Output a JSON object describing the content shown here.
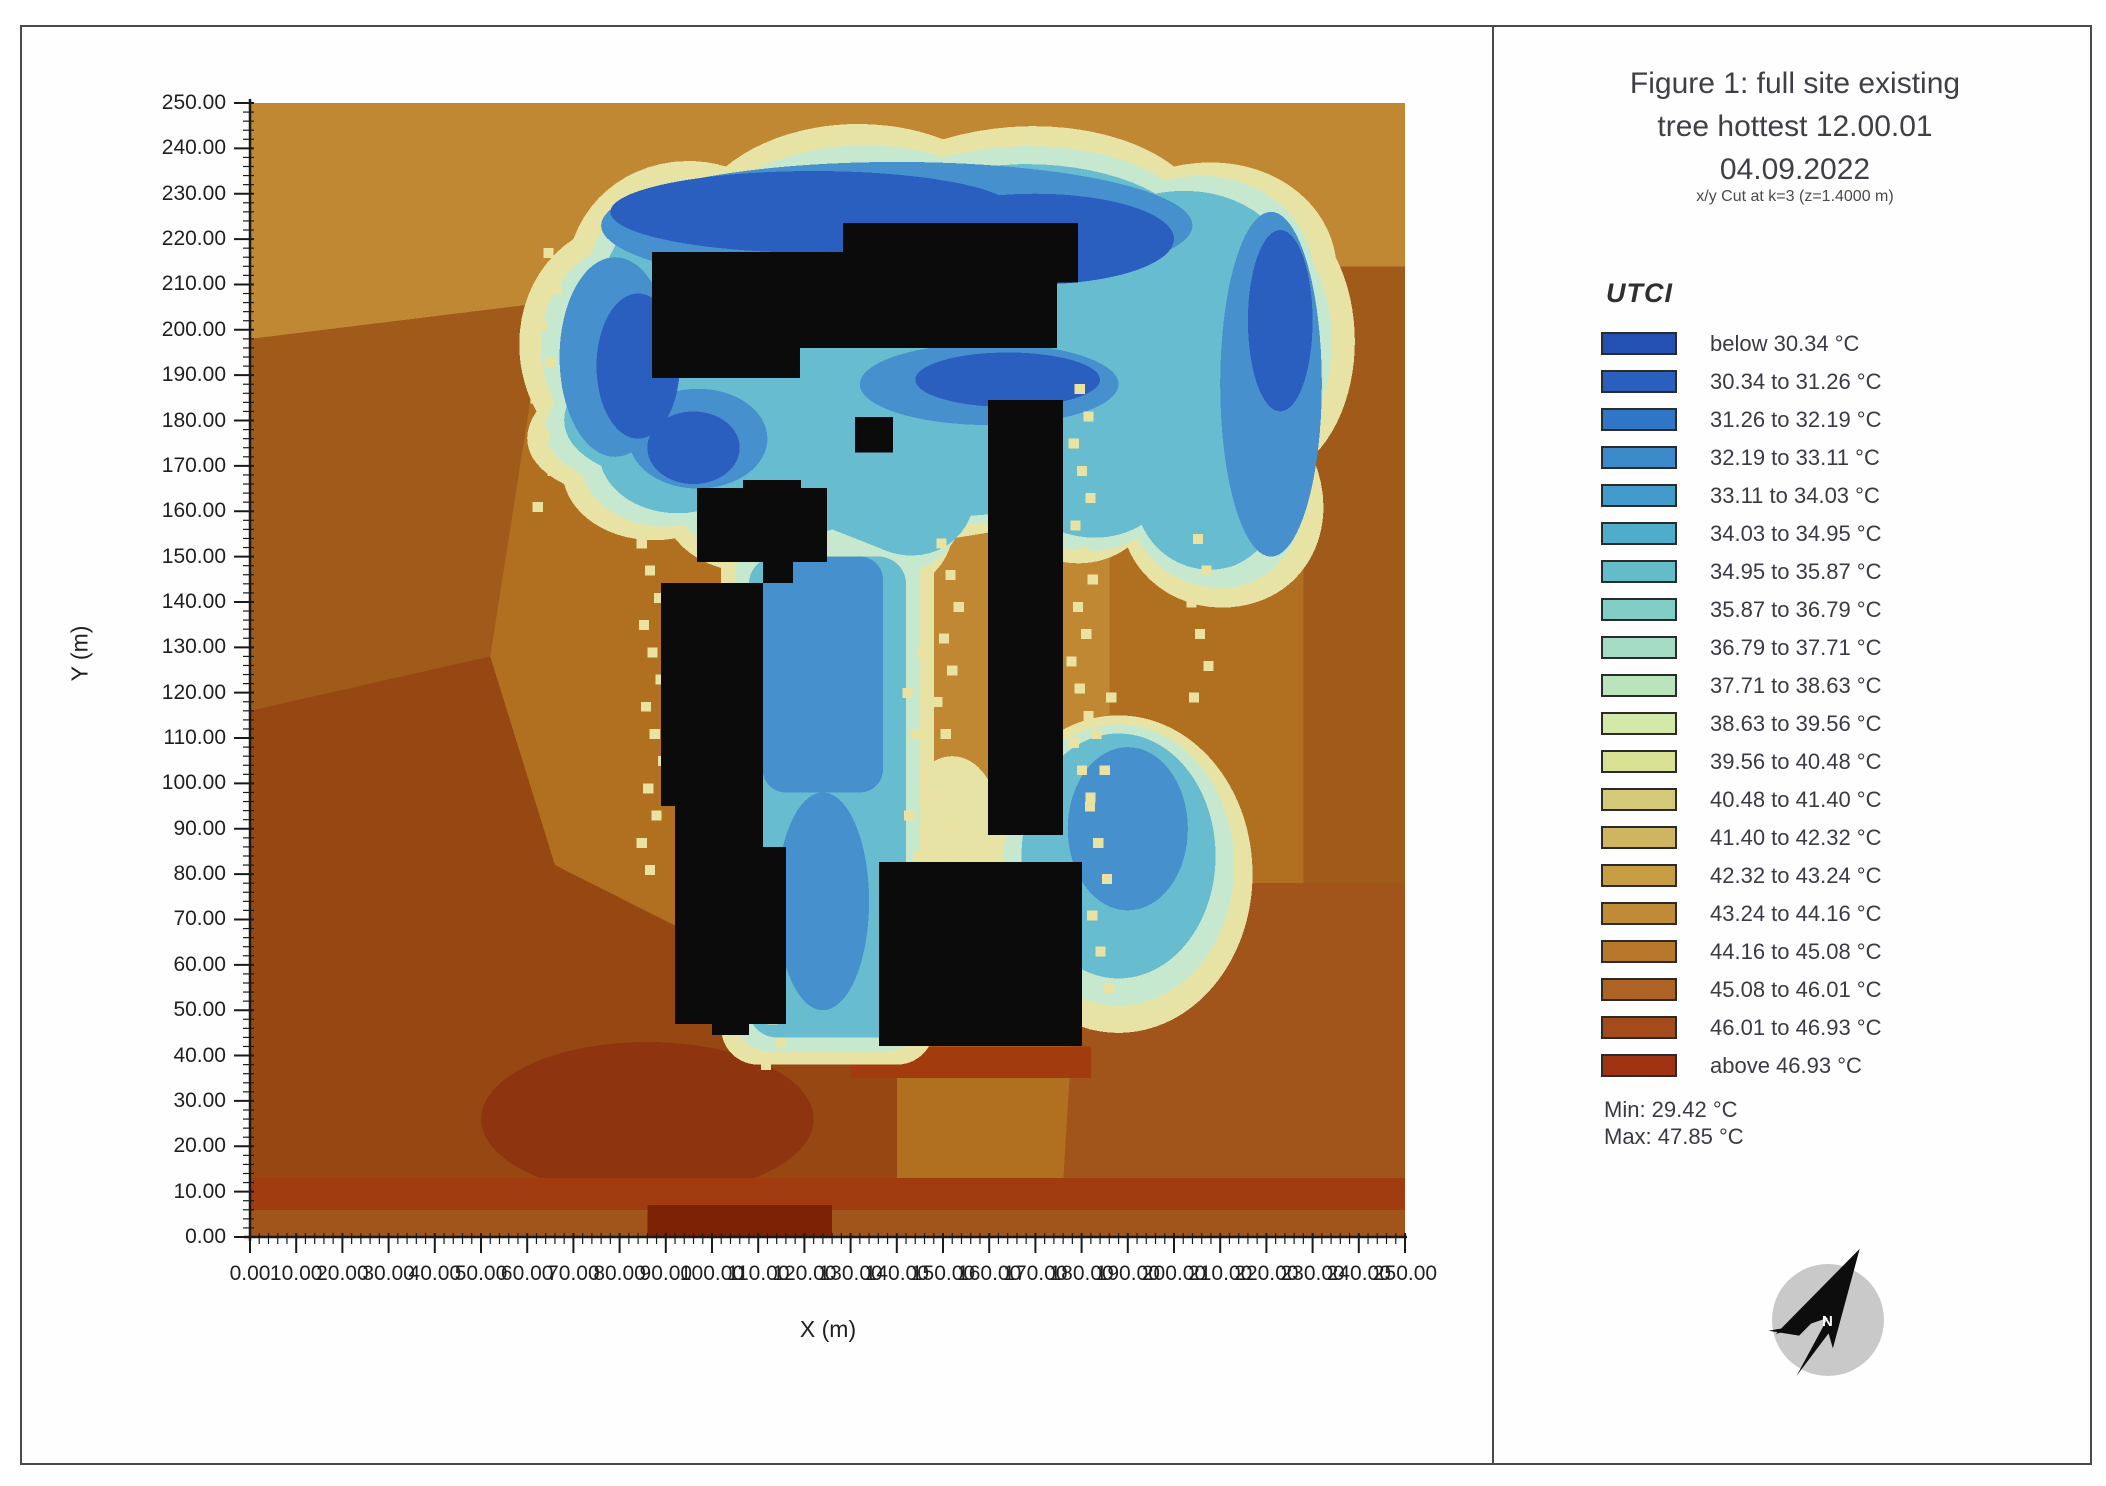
{
  "map": {
    "x_axis": {
      "label": "X (m)",
      "ticks": [
        "0.00",
        "10.00",
        "20.00",
        "30.00",
        "40.00",
        "50.00",
        "60.00",
        "70.00",
        "80.00",
        "90.00",
        "100.00",
        "110.00",
        "120.00",
        "130.00",
        "140.00",
        "150.00",
        "160.00",
        "170.00",
        "180.00",
        "190.00",
        "200.00",
        "210.00",
        "220.00",
        "230.00",
        "240.00",
        "250.00"
      ]
    },
    "y_axis": {
      "label": "Y (m)",
      "ticks": [
        "0.00",
        "10.00",
        "20.00",
        "30.00",
        "40.00",
        "50.00",
        "60.00",
        "70.00",
        "80.00",
        "90.00",
        "100.00",
        "110.00",
        "120.00",
        "130.00",
        "140.00",
        "150.00",
        "160.00",
        "170.00",
        "180.00",
        "190.00",
        "200.00",
        "210.00",
        "220.00",
        "230.00",
        "240.00",
        "250.00"
      ]
    }
  },
  "right_panel": {
    "title_line1": "Figure 1: full site existing",
    "title_line2": "tree hottest 12.00.01",
    "title_line3": "04.09.2022",
    "subtitle": "x/y Cut at k=3 (z=1.4000 m)",
    "legend_title": "UTCI",
    "min_label": "Min: 29.42 °C",
    "max_label": "Max: 47.85 °C",
    "compass_letter": "N"
  },
  "chart_data": {
    "type": "heatmap",
    "title": "Figure 1: full site existing tree hottest 12.00.01 04.09.2022",
    "variable": "UTCI",
    "units": "°C",
    "cut_plane": "x/y Cut at k=3 (z=1.4000 m)",
    "xlabel": "X (m)",
    "ylabel": "Y (m)",
    "xlim": [
      0,
      250
    ],
    "ylim": [
      0,
      250
    ],
    "tick_step_m": 10,
    "min_value": 29.42,
    "max_value": 47.85,
    "bins": [
      {
        "label": "below 30.34 °C",
        "color": "#2450b4"
      },
      {
        "label": "30.34 to 31.26 °C",
        "color": "#2a5fbe"
      },
      {
        "label": "31.26 to 32.19 °C",
        "color": "#2f76c6"
      },
      {
        "label": "32.19 to 33.11 °C",
        "color": "#3c8aca"
      },
      {
        "label": "33.11 to 34.03 °C",
        "color": "#429bcb"
      },
      {
        "label": "34.03 to 34.95 °C",
        "color": "#4fadcc"
      },
      {
        "label": "34.95 to 35.87 °C",
        "color": "#63bcc8"
      },
      {
        "label": "35.87 to 36.79 °C",
        "color": "#82cdc6"
      },
      {
        "label": "36.79 to 37.71 °C",
        "color": "#a4dcc6"
      },
      {
        "label": "37.71 to 38.63 °C",
        "color": "#bce4bc"
      },
      {
        "label": "38.63 to 39.56 °C",
        "color": "#d2e9a8"
      },
      {
        "label": "39.56 to 40.48 °C",
        "color": "#d8e093"
      },
      {
        "label": "40.48 to 41.40 °C",
        "color": "#d5c878"
      },
      {
        "label": "41.40 to 42.32 °C",
        "color": "#cfb560"
      },
      {
        "label": "42.32 to 43.24 °C",
        "color": "#c79c43"
      },
      {
        "label": "43.24 to 44.16 °C",
        "color": "#bf8b36"
      },
      {
        "label": "44.16 to 45.08 °C",
        "color": "#b7782c"
      },
      {
        "label": "45.08 to 46.01 °C",
        "color": "#ae6224"
      },
      {
        "label": "46.01 to 46.93 °C",
        "color": "#a54a1a"
      },
      {
        "label": "above 46.93 °C",
        "color": "#a03312"
      }
    ],
    "buildings_m": [
      {
        "name": "north-west-slab",
        "polygon": [
          [
            87,
            217.2
          ],
          [
            119,
            217.2
          ],
          [
            119,
            189.4
          ],
          [
            87,
            189.4
          ]
        ]
      },
      {
        "name": "north-east-slab",
        "polygon": [
          [
            119,
            217.2
          ],
          [
            128.4,
            217.2
          ],
          [
            128.4,
            223.6
          ],
          [
            179.2,
            223.6
          ],
          [
            179.2,
            210.4
          ],
          [
            174.7,
            210.4
          ],
          [
            174.7,
            196
          ],
          [
            119,
            196
          ]
        ]
      },
      {
        "name": "small-square",
        "polygon": [
          [
            131,
            180.8
          ],
          [
            139.2,
            180.8
          ],
          [
            139.2,
            172.9
          ],
          [
            131,
            172.9
          ]
        ]
      },
      {
        "name": "mid-west-block",
        "polygon": [
          [
            96.8,
            165.1
          ],
          [
            106.7,
            165.1
          ],
          [
            106.7,
            166.9
          ],
          [
            119.3,
            166.9
          ],
          [
            119.3,
            165.1
          ],
          [
            124.9,
            165.1
          ],
          [
            124.9,
            148.8
          ],
          [
            117.5,
            148.8
          ],
          [
            117.5,
            144.2
          ],
          [
            111,
            144.2
          ],
          [
            111,
            148.8
          ],
          [
            96.8,
            148.8
          ]
        ]
      },
      {
        "name": "west-tower",
        "polygon": [
          [
            89,
            144.2
          ],
          [
            111,
            144.2
          ],
          [
            111,
            86
          ],
          [
            116,
            86
          ],
          [
            116,
            47
          ],
          [
            108,
            47
          ],
          [
            108,
            44.5
          ],
          [
            100,
            44.5
          ],
          [
            100,
            47
          ],
          [
            92,
            47
          ],
          [
            92,
            95
          ],
          [
            89,
            95
          ]
        ]
      },
      {
        "name": "east-tower",
        "polygon": [
          [
            159.7,
            184.5
          ],
          [
            176,
            184.5
          ],
          [
            176,
            88.6
          ],
          [
            159.7,
            88.6
          ]
        ]
      },
      {
        "name": "south-east-block",
        "polygon": [
          [
            136.1,
            82.7
          ],
          [
            180.1,
            82.7
          ],
          [
            180.1,
            42.1
          ],
          [
            136.1,
            42.1
          ]
        ]
      }
    ],
    "region_notes": [
      "cool shaded zone (UTCI ~30-38 °C) wraps the northern building cluster and runs down the central courtyard corridor",
      "unshaded ground mostly 43-46 °C (orange-brown)",
      "hottest zone above 46.93 °C in the south-west corner and along the southern edge"
    ]
  }
}
